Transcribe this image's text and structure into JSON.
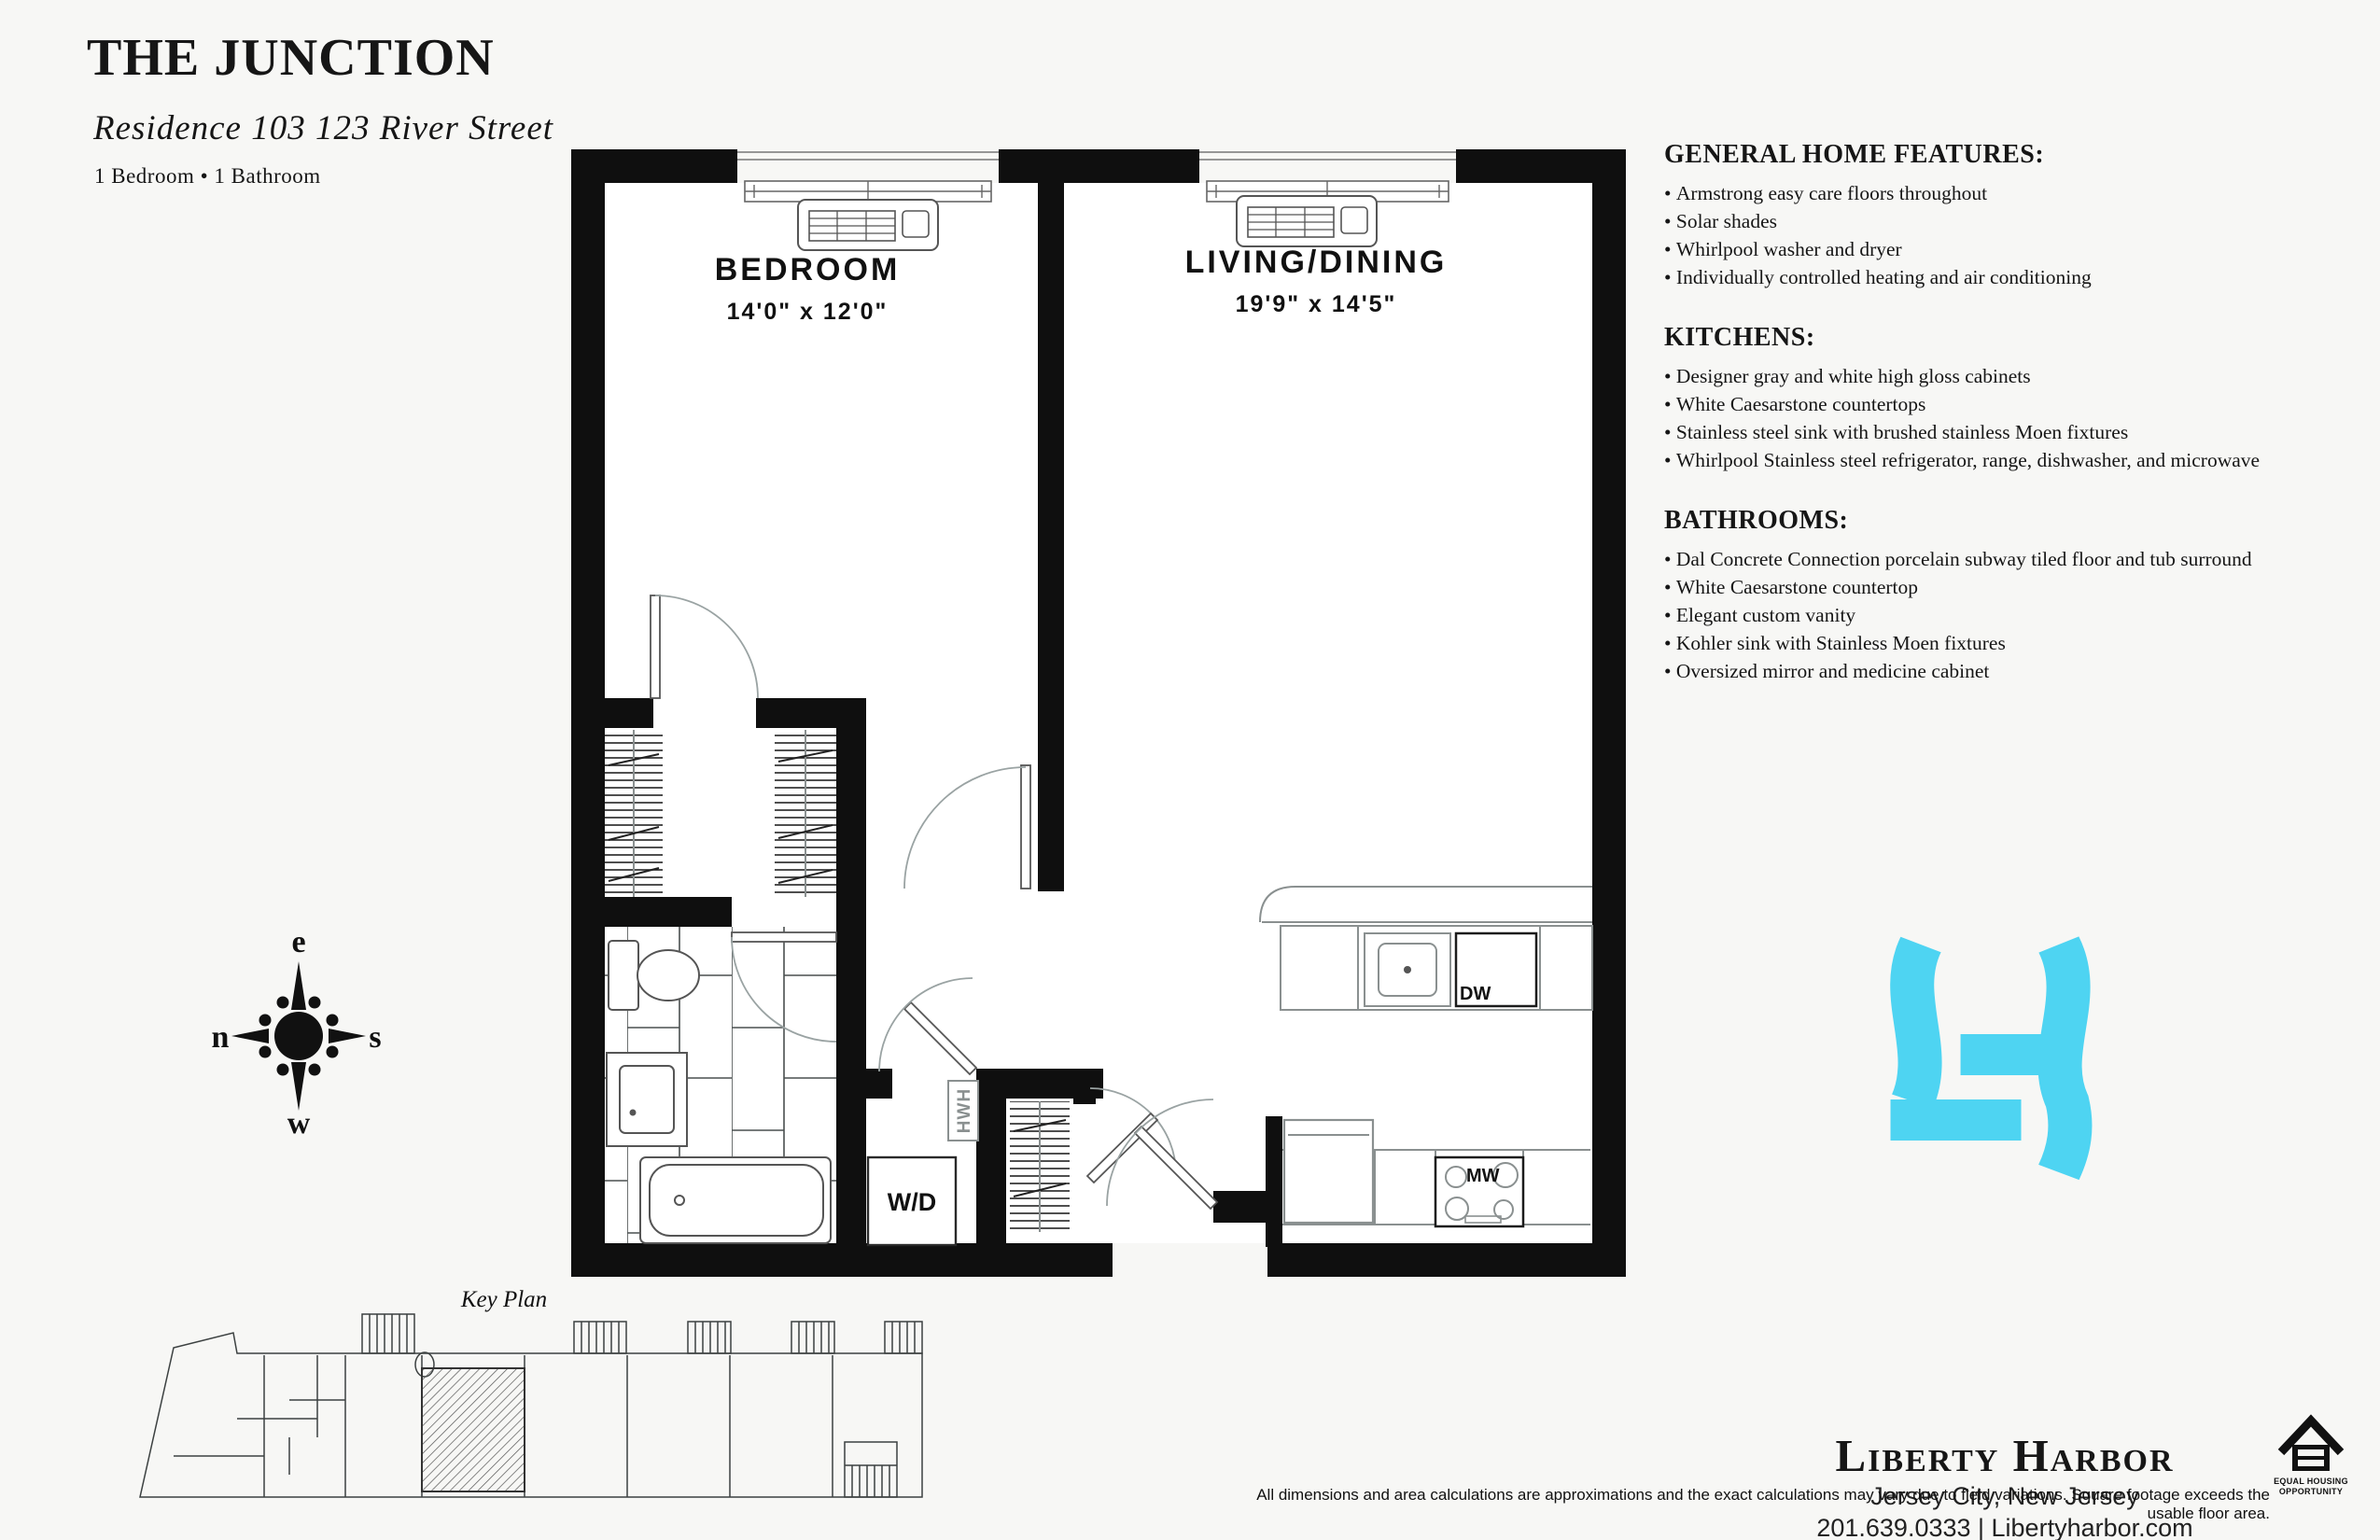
{
  "page": {
    "background": "#f7f7f5"
  },
  "header": {
    "title": "THE JUNCTION",
    "subtitle": "Residence 103 123 River Street",
    "configuration": "1 Bedroom • 1 Bathroom"
  },
  "features": {
    "sections": [
      {
        "heading": "GENERAL HOME FEATURES:",
        "items": [
          "Armstrong easy care floors throughout",
          "Solar shades",
          "Whirlpool washer and dryer",
          "Individually controlled heating and air conditioning"
        ]
      },
      {
        "heading": "KITCHENS:",
        "items": [
          "Designer gray and white high gloss cabinets",
          "White Caesarstone countertops",
          "Stainless steel sink with brushed stainless Moen fixtures",
          "Whirlpool Stainless steel refrigerator, range, dishwasher, and microwave"
        ]
      },
      {
        "heading": "BATHROOMS:",
        "items": [
          "Dal Concrete Connection porcelain subway tiled floor and tub surround",
          "White Caesarstone countertop",
          "Elegant custom vanity",
          "Kohler sink with Stainless Moen fixtures",
          "Oversized mirror and medicine cabinet"
        ]
      }
    ]
  },
  "floorplan": {
    "rooms": [
      {
        "name": "BEDROOM",
        "dims": "14'0\" x 12'0\""
      },
      {
        "name": "LIVING/DINING",
        "dims": "19'9\" x 14'5\""
      }
    ],
    "labels": {
      "washer_dryer": "W/D",
      "hot_water_heater": "HWH",
      "dishwasher": "DW",
      "microwave": "MW"
    }
  },
  "compass": {
    "top": "e",
    "left": "n",
    "right": "s",
    "bottom": "w"
  },
  "keyplan": {
    "label": "Key Plan"
  },
  "brand": {
    "name": "Liberty Harbor",
    "location": "Jersey City, New Jersey",
    "contact": "201.639.0333 | Libertyharbor.com",
    "logo_color": "#4ED4F2"
  },
  "footer": {
    "disclaimer": "All dimensions and area calculations are approximations and the exact calculations may vary due to field variations. Square footage exceeds the usable floor area.",
    "eho_line1": "EQUAL HOUSING",
    "eho_line2": "OPPORTUNITY"
  }
}
